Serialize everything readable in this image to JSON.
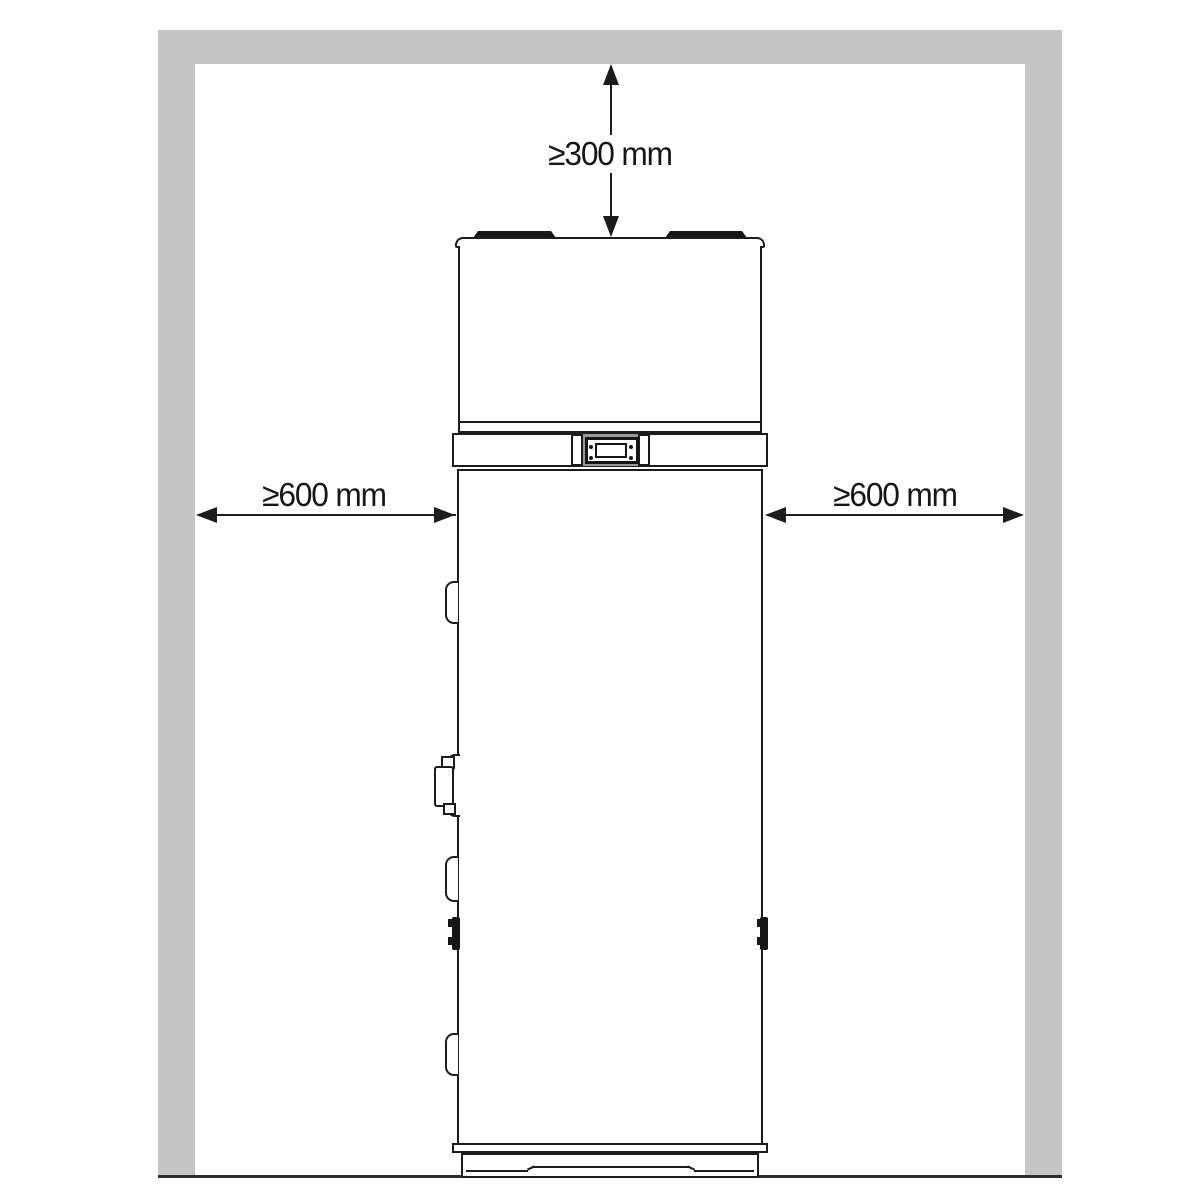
{
  "diagram": {
    "type": "installation-clearance-side-view",
    "colors": {
      "wall": "#c5c5c5",
      "line": "#1c1c1c",
      "panel_backing": "#999999"
    },
    "clearances": {
      "top": "≥300 mm",
      "left": "≥600 mm",
      "right": "≥600 mm"
    }
  }
}
